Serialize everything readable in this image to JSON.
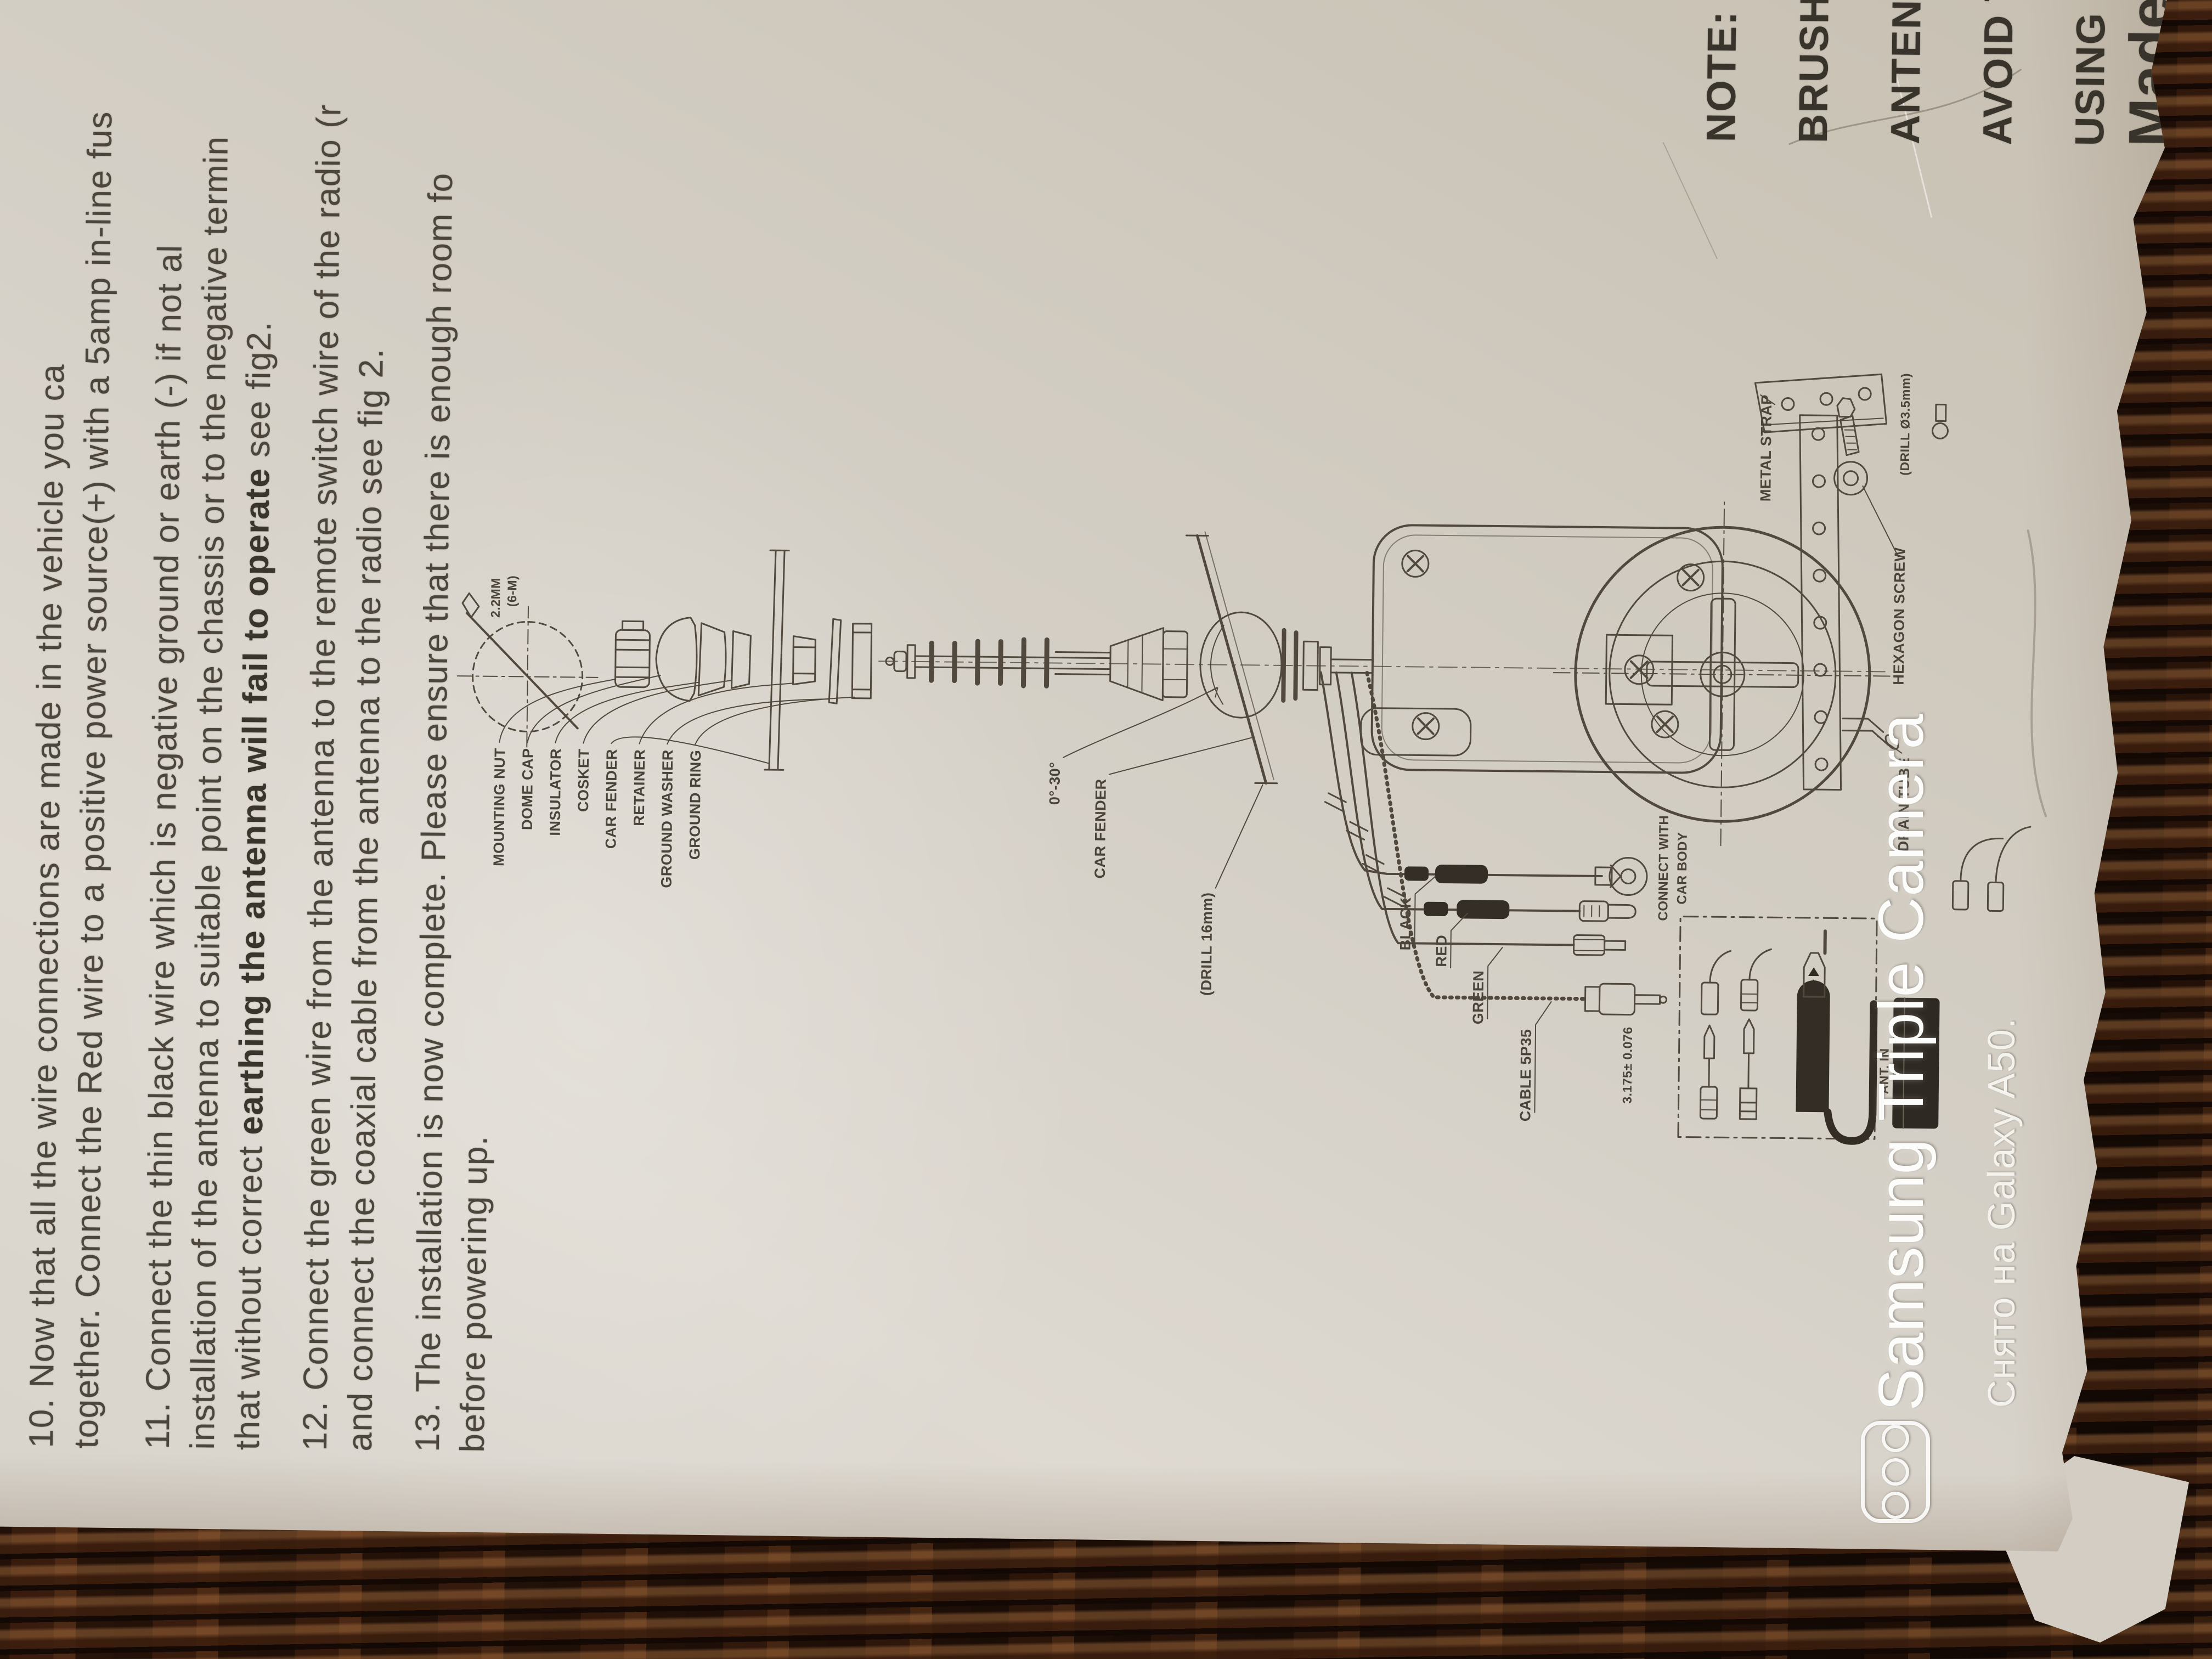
{
  "watermark": {
    "title": "Samsung Triple Camera",
    "subtitle": "Снято на Galaxy A50.",
    "icon": "triple-camera"
  },
  "page": {
    "instructions": {
      "p10": {
        "l1": "10. Now that all the wire connections are made in the vehicle you ca",
        "l2": "together. Connect the Red wire to a positive power source(+) with a 5amp in-line fus"
      },
      "p11": {
        "l1": "11. Connect the  thin black wire which is negative ground or earth (-) if not al",
        "l2": "installation of the antenna to suitable point on the chassis or to the negative termin",
        "l3_pre": "that without correct ",
        "l3_bold": "earthing the antenna will fail to operate",
        "l3_post": " see fig2."
      },
      "p12": {
        "l1": "12. Connect the green wire from the antenna to the remote switch wire of the radio (r",
        "l2": "and connect the coaxial cable from the antenna to the radio see fig 2."
      },
      "p13": {
        "l1": "13. The installation is now complete. Please ensure that there is enough room fo",
        "l2": "before powering up."
      }
    },
    "exploded_labels": [
      "MOUNTING NUT",
      "DOME CAP",
      "INSULATOR",
      "COSKET",
      "CAR FENDER",
      "RETAINER",
      "GROUND WASHER",
      "GROUND RING"
    ],
    "hole": {
      "size": "2.2MM",
      "note": "(6-M)"
    },
    "assembly": {
      "angle": "0°-30°",
      "car_fender": "CAR FENDER",
      "drill_fender": "(DRILL 16mm)"
    },
    "wires": {
      "black": "BLACK",
      "red": "RED",
      "green": "GREEN",
      "cable": "CABLE 5P35",
      "connect_l1": "CONNECT WITH",
      "connect_l2": "CAR BODY",
      "tolerance": "3.175± 0.076"
    },
    "motor": {
      "metal_strap": "METAL STRAP",
      "hexagon_screw": "HEXAGON SCREW",
      "drill_note": "(DRILL Ø3.5mm)",
      "drain_tube": "DRAIN TUBE",
      "radio_label": "ANT. IN"
    },
    "note": {
      "l1": "NOTE:",
      "l2": "BRUSH",
      "l3": "ANTENN",
      "l4": "AVOID T",
      "l5": "USING E",
      "made": "Made"
    }
  }
}
